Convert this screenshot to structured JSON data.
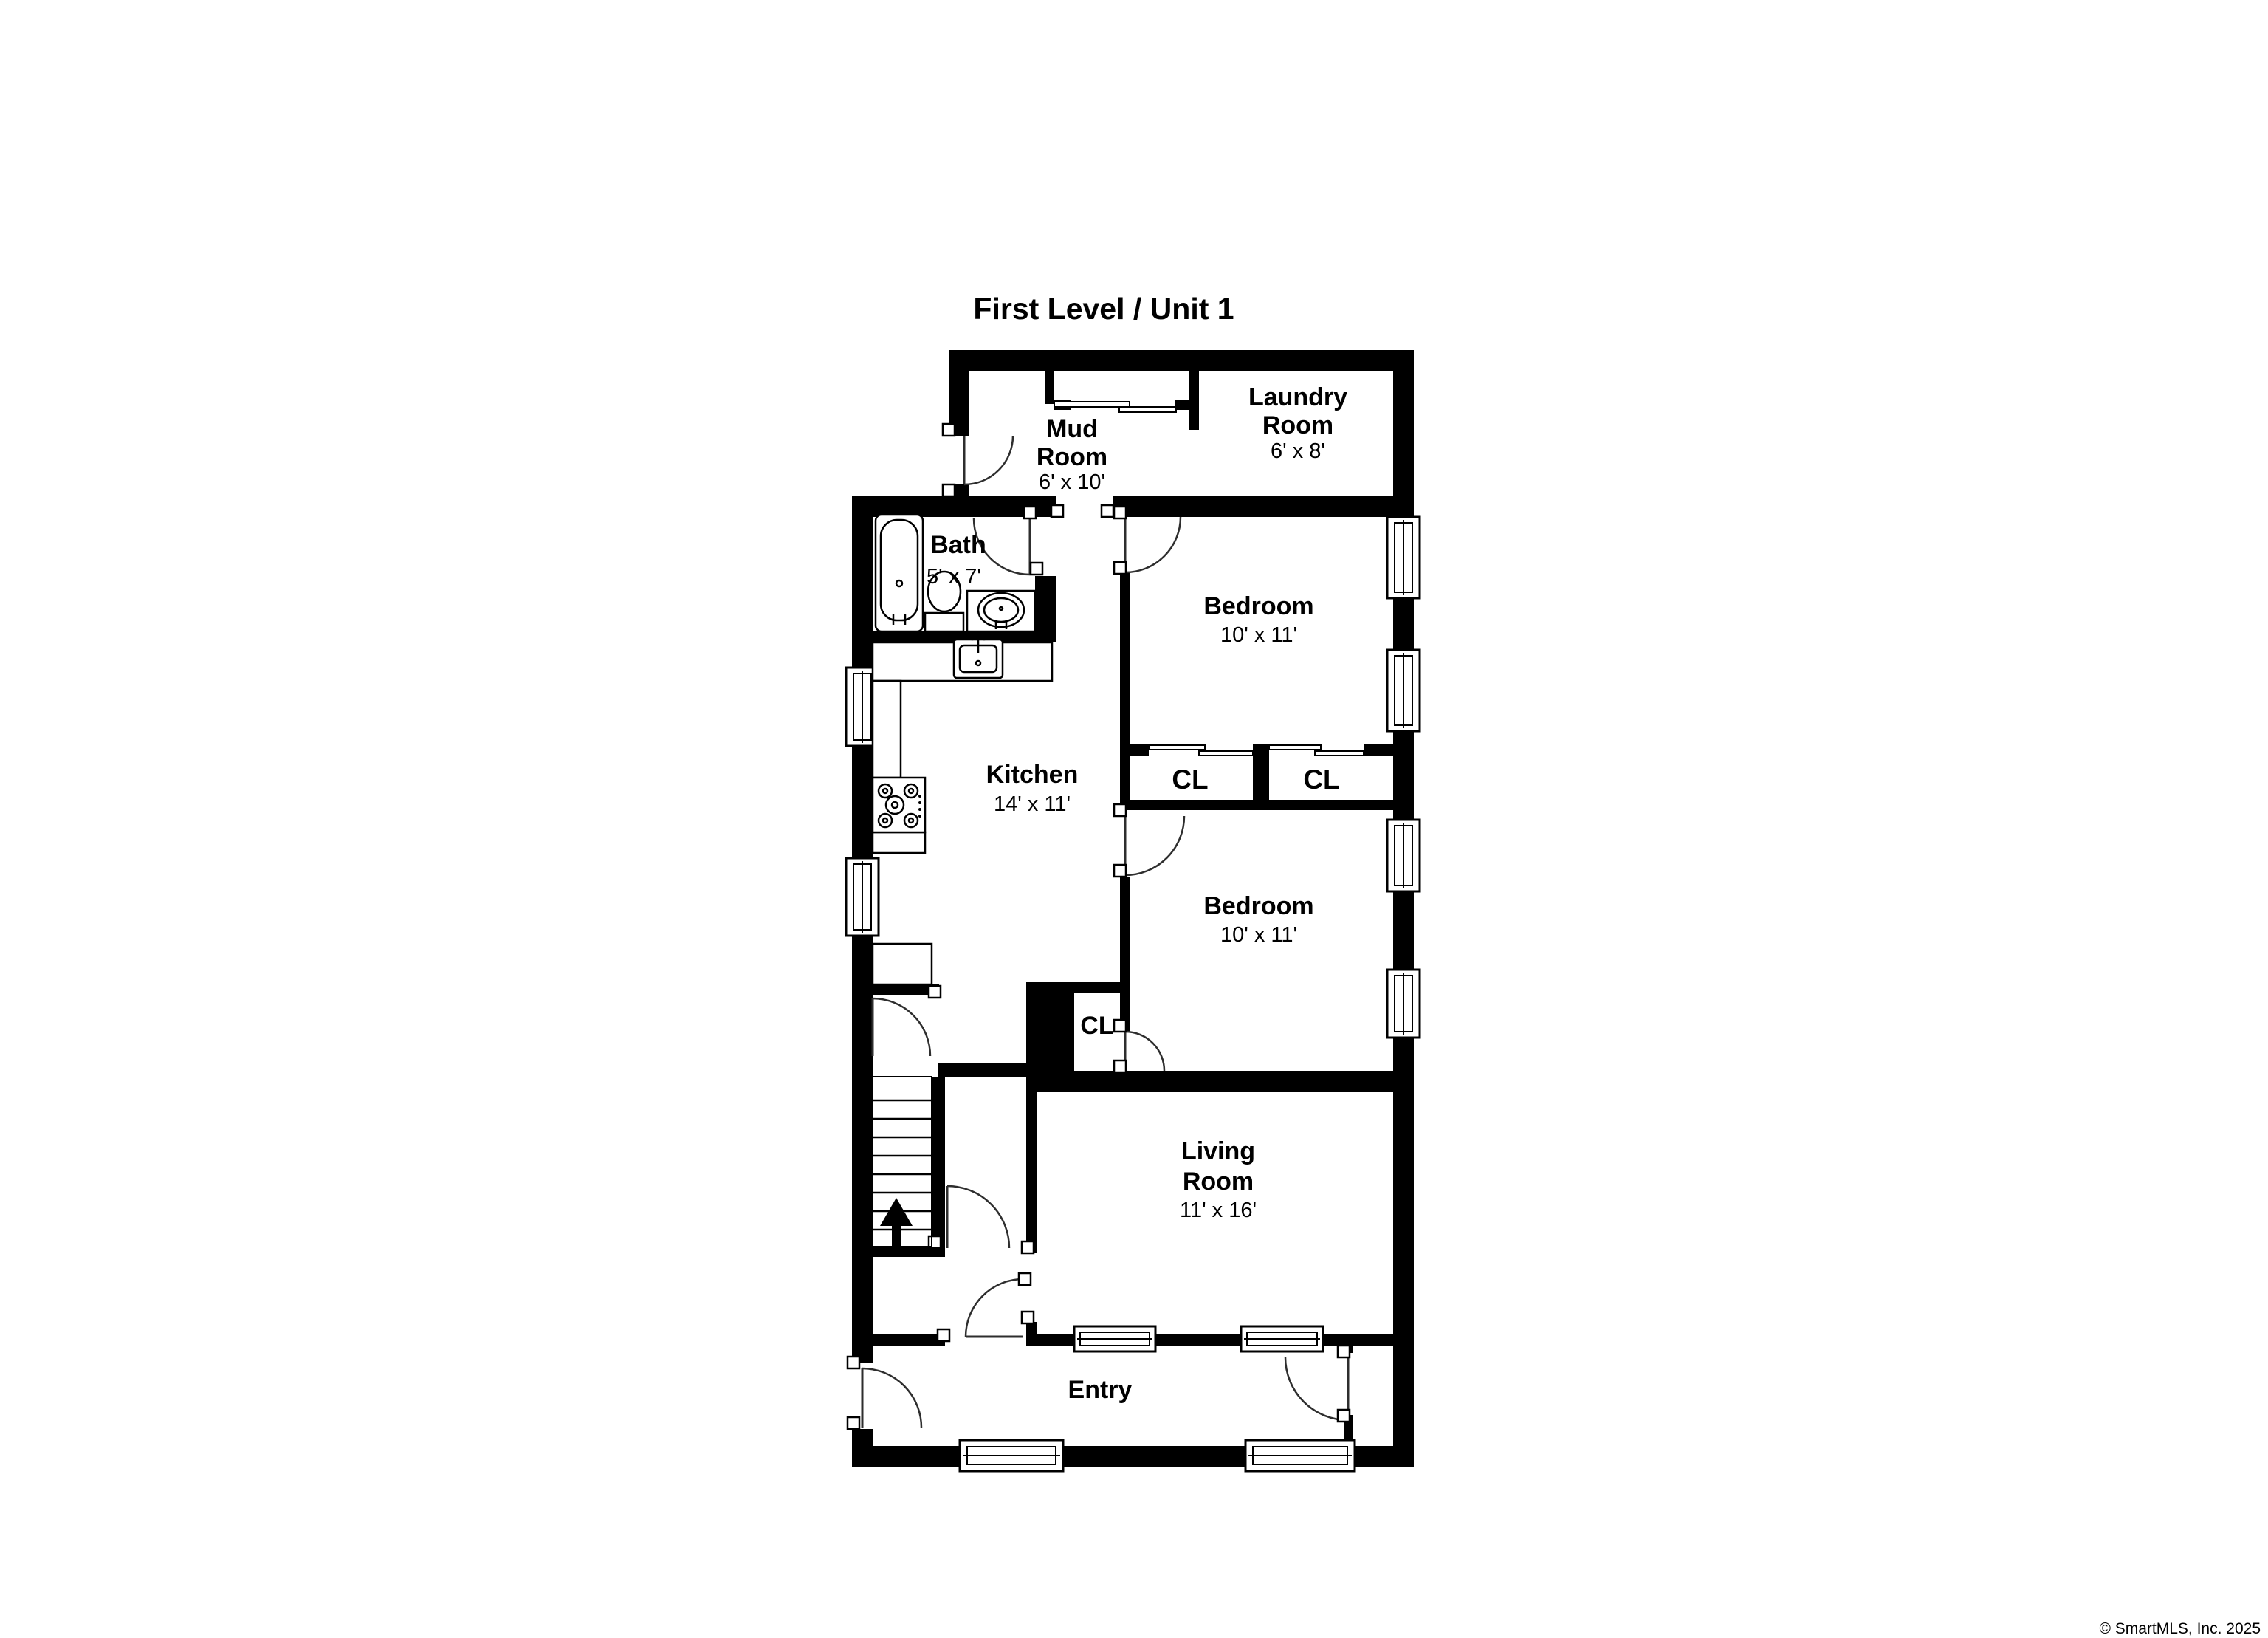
{
  "title": "First Level / Unit 1",
  "watermark": "© SmartMLS, Inc. 2025",
  "colors": {
    "wall": "#000000",
    "background": "#ffffff",
    "door_arc": "#2e2e2e",
    "watermark": "#b9b9b9"
  },
  "rooms": {
    "mud_room": {
      "name_line1": "Mud",
      "name_line2": "Room",
      "dimensions": "6' x 10'"
    },
    "laundry_room": {
      "name_line1": "Laundry",
      "name_line2": "Room",
      "dimensions": "6' x 8'"
    },
    "bath": {
      "name": "Bath",
      "dimensions": "5' x 7'"
    },
    "bedroom_top": {
      "name": "Bedroom",
      "dimensions": "10' x 11'"
    },
    "kitchen": {
      "name": "Kitchen",
      "dimensions": "14' x 11'"
    },
    "closet_top_left": {
      "name": "CL"
    },
    "closet_top_right": {
      "name": "CL"
    },
    "closet_hall": {
      "name": "CL"
    },
    "bedroom_middle": {
      "name": "Bedroom",
      "dimensions": "10' x 11'"
    },
    "living_room": {
      "name_line1": "Living",
      "name_line2": "Room",
      "dimensions": "11' x 16'"
    },
    "entry": {
      "name": "Entry"
    }
  }
}
